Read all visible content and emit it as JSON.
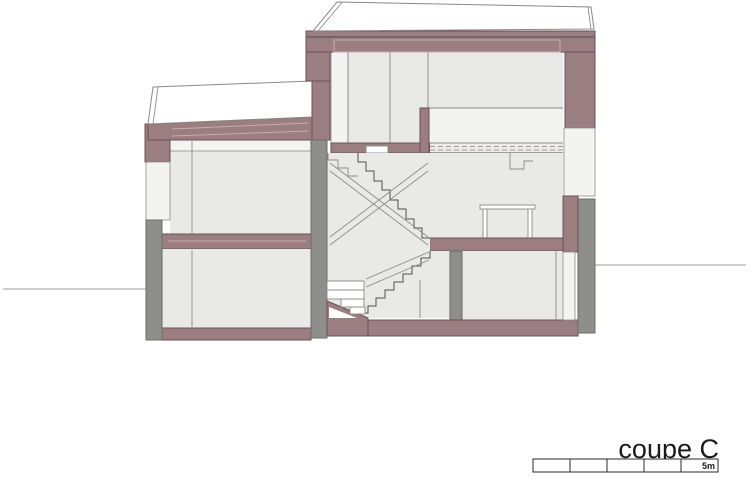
{
  "title": {
    "label": "coupe C"
  },
  "scale_bar": {
    "label": "5m",
    "segments": 5
  },
  "colors": {
    "wall-cut": "#9b7e7f",
    "wall-cut-stroke": "#6a5354",
    "wall-gray": "#8e8e8b",
    "wall-gray-stroke": "#6c6c69",
    "room-fill": "#e9e9e7",
    "window-fill": "#f3f3f1",
    "line": "#8b8b88",
    "line-dark": "#4f4f4d",
    "inset-line": "#c4aeae",
    "ground-line": "#9b9b9b",
    "text": "#1a1a1a",
    "bar-stroke": "#2b2b2b"
  }
}
